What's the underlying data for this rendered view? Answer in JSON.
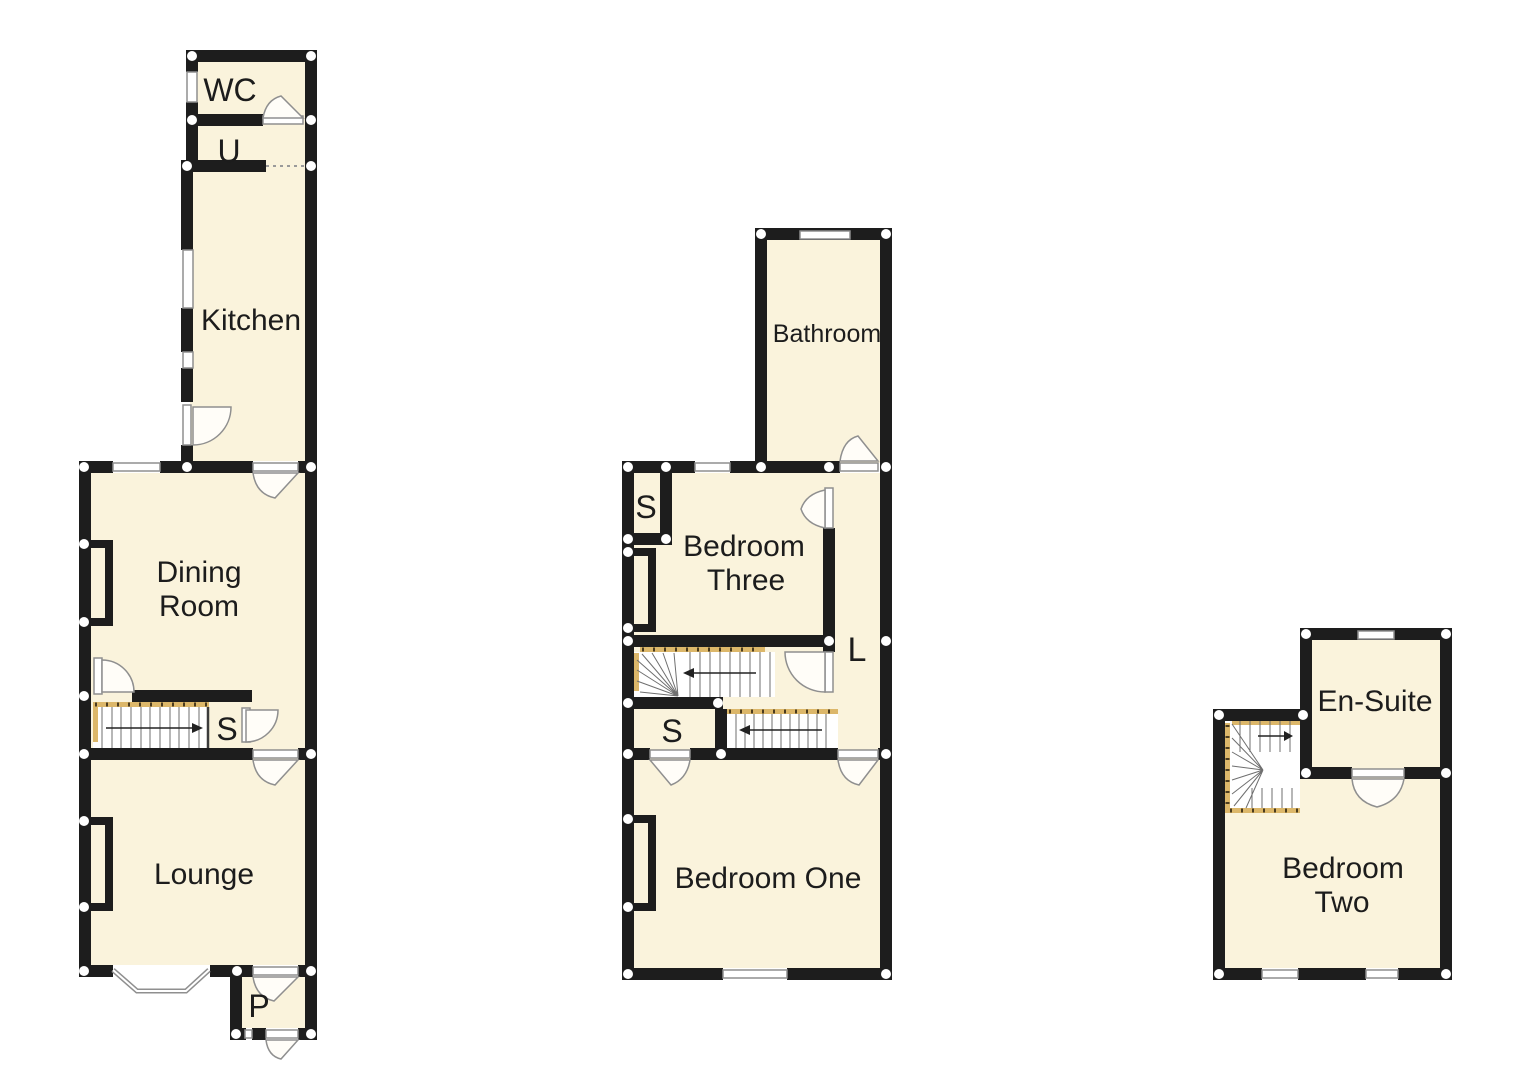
{
  "document": {
    "type": "property-floorplan",
    "floor_count": 3
  },
  "colors": {
    "wall": "#1d1d1d",
    "room_fill": "#faf3dc",
    "stair_fill": "#ffffff",
    "rail": "#dcb76a",
    "outline": "#8f8f8f",
    "text": "#1c1c1c",
    "junction_dot": "#ffffff",
    "arc_fill": "#fffdf8",
    "background": "#ffffff"
  },
  "floors": [
    {
      "name": "ground-floor",
      "labels": {
        "wc": "WC",
        "u": "U",
        "kitchen": "Kitchen",
        "dining_line1": "Dining",
        "dining_line2": "Room",
        "stairs_cupboard": "S",
        "lounge": "Lounge",
        "porch": "P"
      }
    },
    {
      "name": "first-floor",
      "labels": {
        "bathroom": "Bathroom",
        "store_top": "S",
        "bed3_line1": "Bedroom",
        "bed3_line2": "Three",
        "landing": "L",
        "store_mid": "S",
        "bed1": "Bedroom One"
      }
    },
    {
      "name": "second-floor",
      "labels": {
        "ensuite": "En-Suite",
        "bed2_line1": "Bedroom",
        "bed2_line2": "Two"
      }
    }
  ]
}
